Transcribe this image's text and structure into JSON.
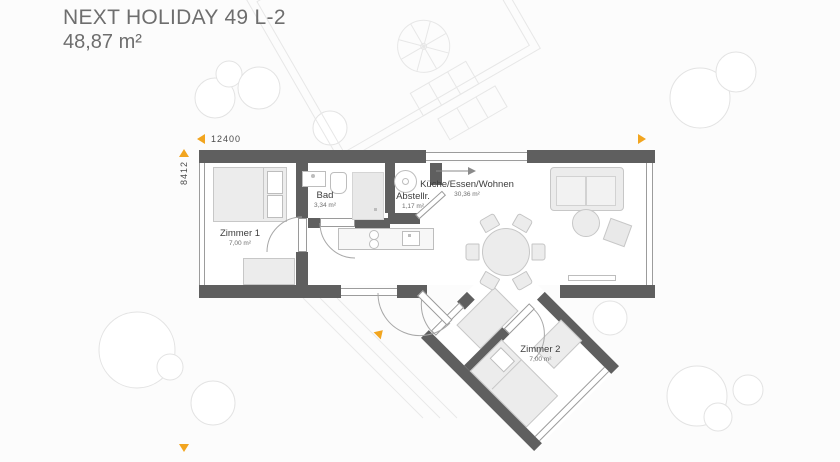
{
  "header": {
    "title": "NEXT HOLIDAY 49 L-2",
    "total_area": "48,87 m²"
  },
  "dimensions": {
    "width_label": "12400",
    "height_label": "8412"
  },
  "rooms": {
    "zimmer1": {
      "name": "Zimmer 1",
      "area": "7,00 m²"
    },
    "bad": {
      "name": "Bad",
      "area": "3,34 m²"
    },
    "abstellraum": {
      "name": "Abstellr.",
      "area": "1,17 m²"
    },
    "wohnen": {
      "name": "Küche/Essen/Wohnen",
      "area": "30,36 m²"
    },
    "zimmer2": {
      "name": "Zimmer 2",
      "area": "7,00 m²"
    }
  },
  "colors": {
    "wall": "#5f5f5f",
    "accent_orange": "#f2a51f",
    "furniture_fill": "#ececec",
    "furniture_stroke": "#c7c7c7",
    "tree_stroke": "#e3e3e3",
    "title_text": "#6e6e6e",
    "label_text": "#3d3d3d"
  }
}
